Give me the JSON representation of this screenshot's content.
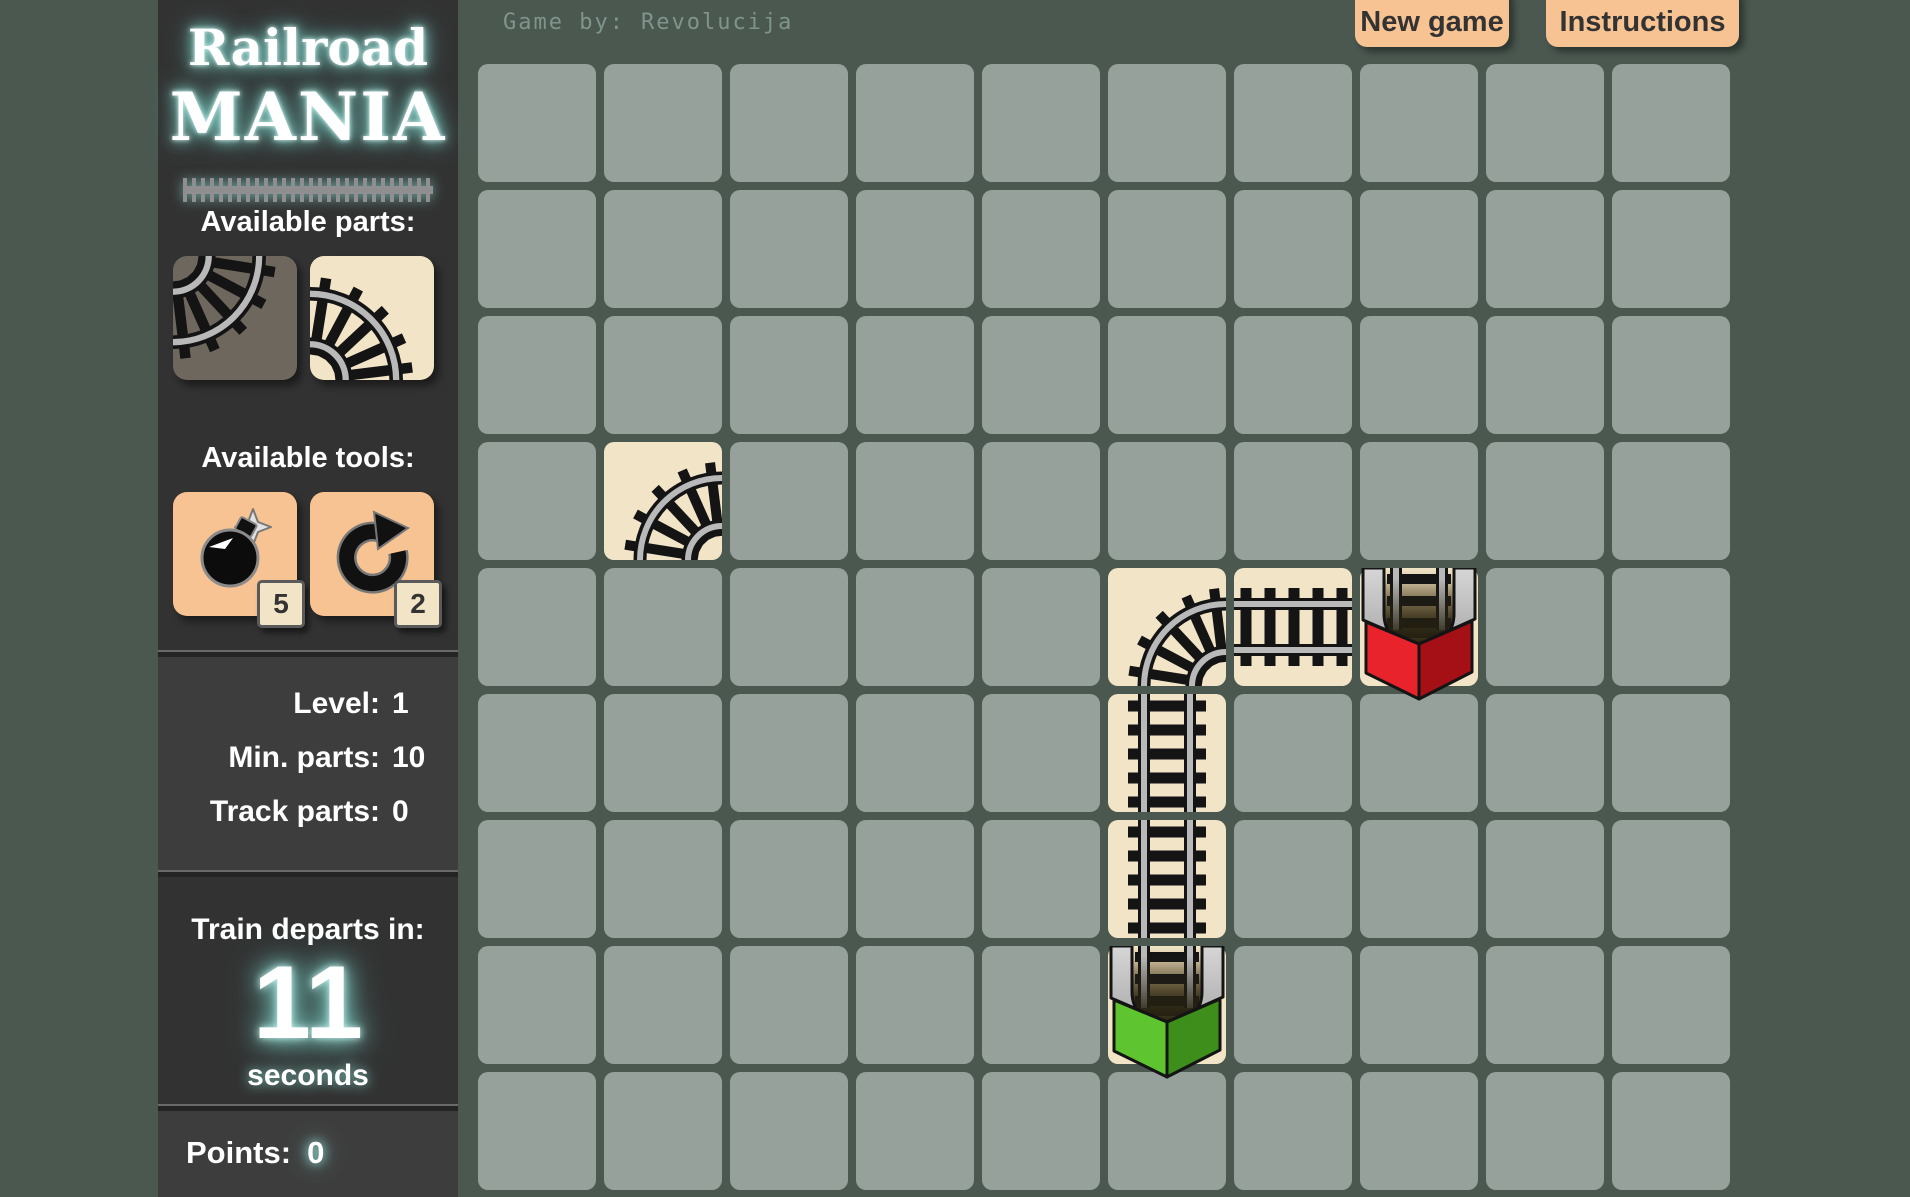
{
  "logo": {
    "line1": "Railroad",
    "line2": "MANIA"
  },
  "credit": {
    "label": "Game by:",
    "value": "Revolucija"
  },
  "toolbar": {
    "new_game": "New game",
    "instructions": "Instructions"
  },
  "sidebar": {
    "parts_heading": "Available parts:",
    "parts": [
      {
        "name": "curve-top-left",
        "kind": "curve",
        "rotation": 180,
        "bg": "#6e675d"
      },
      {
        "name": "curve-left-bottom",
        "kind": "curve",
        "rotation": 90,
        "bg": "#f2e5c7"
      }
    ],
    "tools_heading": "Available tools:",
    "tools": [
      {
        "name": "bomb",
        "count": "5"
      },
      {
        "name": "rotate",
        "count": "2"
      }
    ],
    "stats": [
      {
        "label": "Level:",
        "value": "1"
      },
      {
        "label": "Min. parts:",
        "value": "10"
      },
      {
        "label": "Track parts:",
        "value": "0"
      }
    ],
    "departs": {
      "heading": "Train departs in:",
      "value": "11",
      "unit": "seconds"
    },
    "points": {
      "label": "Points:",
      "value": "0"
    }
  },
  "board": {
    "cols": 10,
    "rows": 9,
    "pieces": [
      {
        "type": "curve",
        "rotation": 0,
        "col": 1,
        "row": 3
      },
      {
        "type": "curve",
        "rotation": 0,
        "col": 5,
        "row": 4
      },
      {
        "type": "straight",
        "orientation": "h",
        "col": 6,
        "row": 4
      },
      {
        "type": "station",
        "color": "red",
        "col": 7,
        "row": 4
      },
      {
        "type": "straight",
        "orientation": "v",
        "col": 5,
        "row": 5
      },
      {
        "type": "straight",
        "orientation": "v",
        "col": 5,
        "row": 6
      },
      {
        "type": "station",
        "color": "green",
        "col": 5,
        "row": 7
      }
    ]
  },
  "station_colors": {
    "red": [
      "#e8232b",
      "#a50f16"
    ],
    "green": [
      "#5ec42f",
      "#3d8e1a"
    ]
  },
  "colors": {
    "background": "#4a5850",
    "empty_tile": "#96a19b",
    "track_tile": "#f2e5c7",
    "sidebar_dark": "#323232",
    "sidebar_panel": "#3d3d3d",
    "accent_peach": "#f7c392",
    "glow_teal": "#8fe3da",
    "rail_gray": "#b9b9b9",
    "tie_black": "#141414"
  }
}
